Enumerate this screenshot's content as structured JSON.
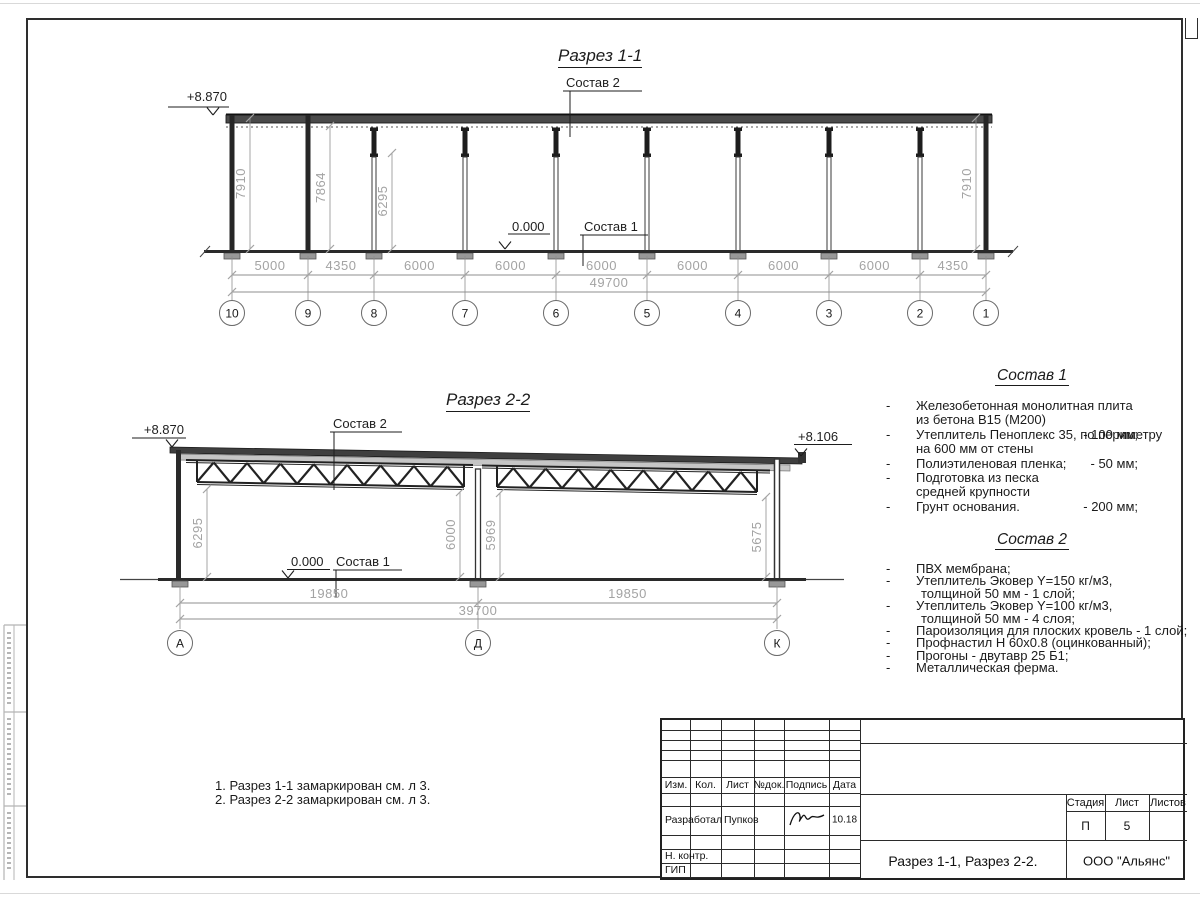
{
  "section1": {
    "title": "Разрез 1-1",
    "elev_top": "+8.870",
    "elev_floor": "0.000",
    "label_roof": "Состав 2",
    "label_floor": "Состав 1",
    "dims_vertical": [
      "7910",
      "7864",
      "6295",
      "7910"
    ],
    "dims_bottom": [
      "5000",
      "4350",
      "6000",
      "6000",
      "6000",
      "6000",
      "6000",
      "6000",
      "4350"
    ],
    "dim_total": "49700",
    "grids": [
      "10",
      "9",
      "8",
      "7",
      "6",
      "5",
      "4",
      "3",
      "2",
      "1"
    ]
  },
  "section2": {
    "title": "Разрез 2-2",
    "elev_top_left": "+8.870",
    "elev_top_right": "+8.106",
    "elev_floor": "0.000",
    "label_roof": "Состав 2",
    "label_floor": "Состав 1",
    "dims_vertical": [
      "6295",
      "6000",
      "5969",
      "5675"
    ],
    "dims_bottom": [
      "19850",
      "19850"
    ],
    "dim_total": "39700",
    "grids": [
      "А",
      "Д",
      "К"
    ]
  },
  "sostav1": {
    "title": "Состав 1",
    "items": [
      {
        "lines": [
          "Железобетонная  монолитная плита",
          "из бетона В15 (М200)"
        ],
        "value": "- 100 мм;"
      },
      {
        "lines": [
          "Утеплитель Пеноплекс 35, по периметру",
          "на 600 мм от стены"
        ],
        "value": "- 50 мм;"
      },
      {
        "lines": [
          "Полиэтиленовая пленка;"
        ]
      },
      {
        "lines": [
          "Подготовка из песка",
          "средней крупности"
        ],
        "value": "- 200 мм;"
      },
      {
        "lines": [
          "Грунт основания."
        ]
      }
    ]
  },
  "sostav2": {
    "title": "Состав 2",
    "items": [
      {
        "lines": [
          "ПВХ мембрана;"
        ]
      },
      {
        "lines": [
          "Утеплитель Эковер Y=150 кг/м3,",
          "толщиной 50 мм - 1 слой;"
        ]
      },
      {
        "lines": [
          "Утеплитель Эковер Y=100 кг/м3,",
          "толщиной 50 мм - 4 слоя;"
        ]
      },
      {
        "lines": [
          "Пароизоляция для плоских кровель - 1 слой;"
        ]
      },
      {
        "lines": [
          "Профнастил Н 60х0.8 (оцинкованный);"
        ]
      },
      {
        "lines": [
          "Прогоны - двутавр 25 Б1;"
        ]
      },
      {
        "lines": [
          "Металлическая ферма."
        ]
      }
    ]
  },
  "notes": [
    "1. Разрез 1-1 замаркирован см. л 3.",
    "2. Разрез 2-2 замаркирован см. л 3."
  ],
  "titleblock": {
    "headers": [
      "Изм.",
      "Кол.",
      "Лист",
      "№док.",
      "Подпись",
      "Дата"
    ],
    "row_developer": {
      "role": "Разработал",
      "name": "Пупков",
      "date": "10.18"
    },
    "row_ncontr": "Н. контр.",
    "row_gip": "ГИП",
    "doc_title": "Разрез 1-1, Разрез 2-2.",
    "company": "ООО \"Альянс\"",
    "stage_label": "Стадия",
    "sheet_label": "Лист",
    "sheets_label": "Листов",
    "stage": "П",
    "sheet": "5",
    "sheets": ""
  },
  "colors": {
    "line": "#242424",
    "dim": "#a3a3a3",
    "ext": "#8f8f8f",
    "roof_fill": "#4a4a4a",
    "pad_fill": "#989898"
  }
}
